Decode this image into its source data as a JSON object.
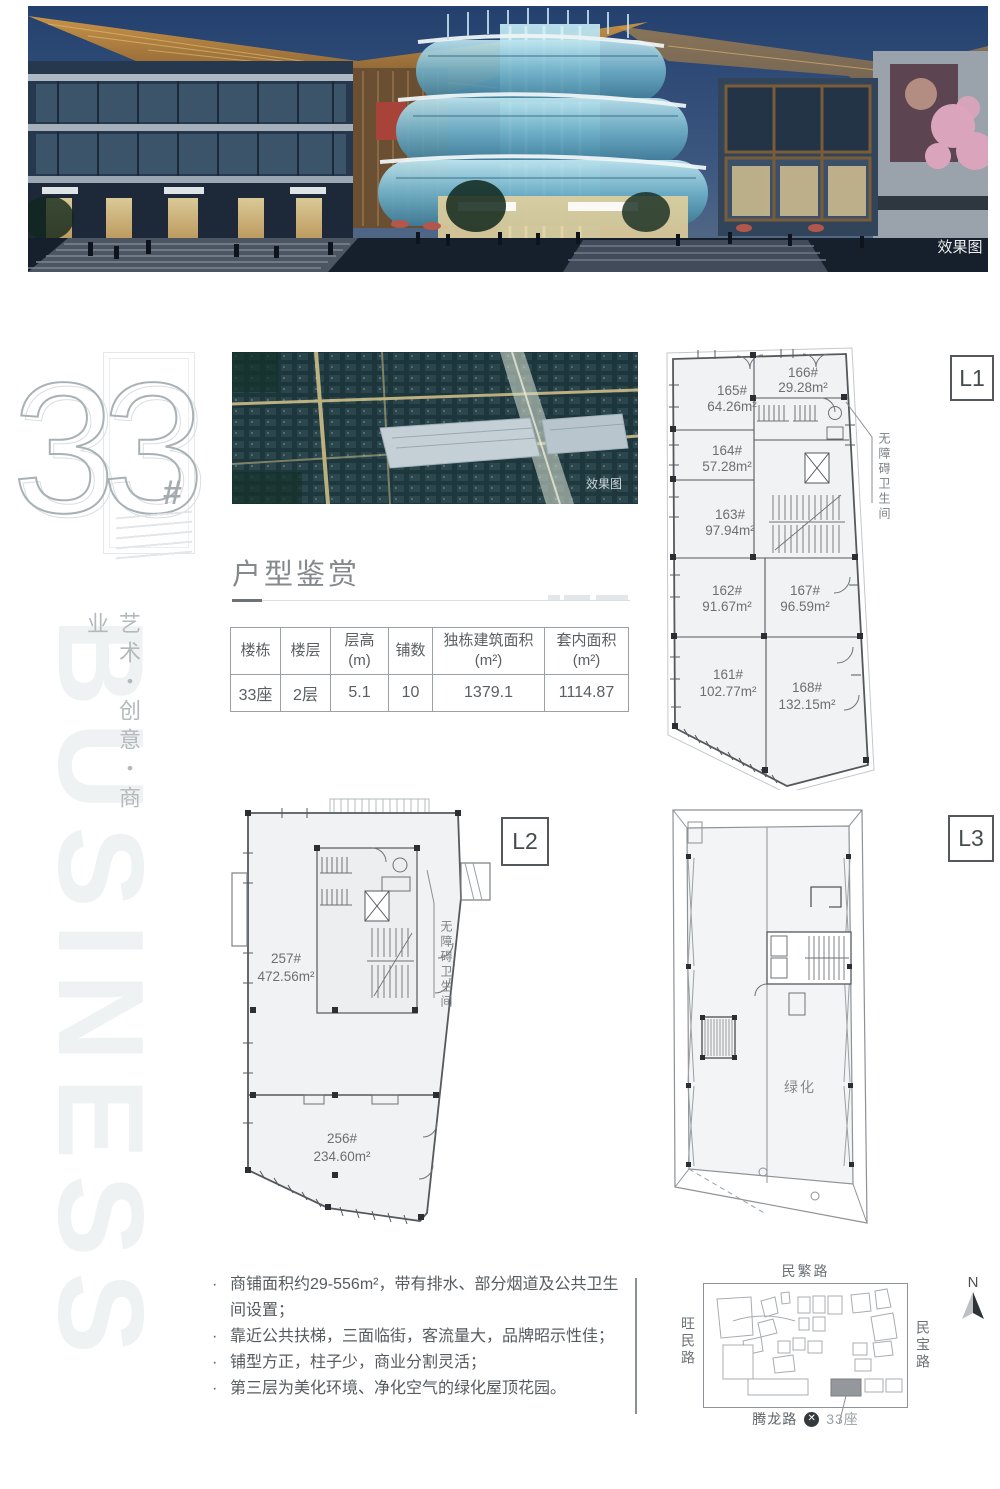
{
  "hero": {
    "watermark": "效果图"
  },
  "aerial": {
    "watermark": "效果图"
  },
  "logo": {
    "big_number": "33",
    "hash": "#"
  },
  "slogan_vertical": "艺术・创意・商业",
  "watermark_word": "BUSINESS",
  "section_title": "户型鉴赏",
  "spec_table": {
    "headers": [
      "楼栋",
      "楼层",
      "层高(m)",
      "铺数",
      "独栋建筑面积(m²)",
      "套内面积(m²)"
    ],
    "row": [
      "33座",
      "2层",
      "5.1",
      "10",
      "1379.1",
      "1114.87"
    ]
  },
  "plan_l1": {
    "label": "L1",
    "annotation": "无障碍卫生间",
    "rooms": [
      {
        "no": "165#",
        "area": "64.26m²"
      },
      {
        "no": "166#",
        "area": "29.28m²"
      },
      {
        "no": "164#",
        "area": "57.28m²"
      },
      {
        "no": "163#",
        "area": "97.94m²"
      },
      {
        "no": "162#",
        "area": "91.67m²"
      },
      {
        "no": "167#",
        "area": "96.59m²"
      },
      {
        "no": "161#",
        "area": "102.77m²"
      },
      {
        "no": "168#",
        "area": "132.15m²"
      }
    ]
  },
  "plan_l2": {
    "label": "L2",
    "annotation": "无障碍卫生间",
    "rooms": [
      {
        "no": "257#",
        "area": "472.56m²"
      },
      {
        "no": "256#",
        "area": "234.60m²"
      }
    ]
  },
  "plan_l3": {
    "label": "L3",
    "green": "绿化"
  },
  "bullet_marker": "·",
  "bullets": [
    "商铺面积约29-556m²，带有排水、部分烟道及公共卫生间设置；",
    "靠近公共扶梯，三面临街，客流量大，品牌昭示性佳；",
    "铺型方正，柱子少，商业分割灵活；",
    "第三层为美化环境、净化空气的绿化屋顶花园。"
  ],
  "map": {
    "road_top": "民繁路",
    "road_left": "旺民路",
    "road_right": "民宝路",
    "road_bottom": "腾龙路",
    "building": "33座",
    "metro_glyph": "✕",
    "compass": "N",
    "accent_dark": "#94989c"
  }
}
